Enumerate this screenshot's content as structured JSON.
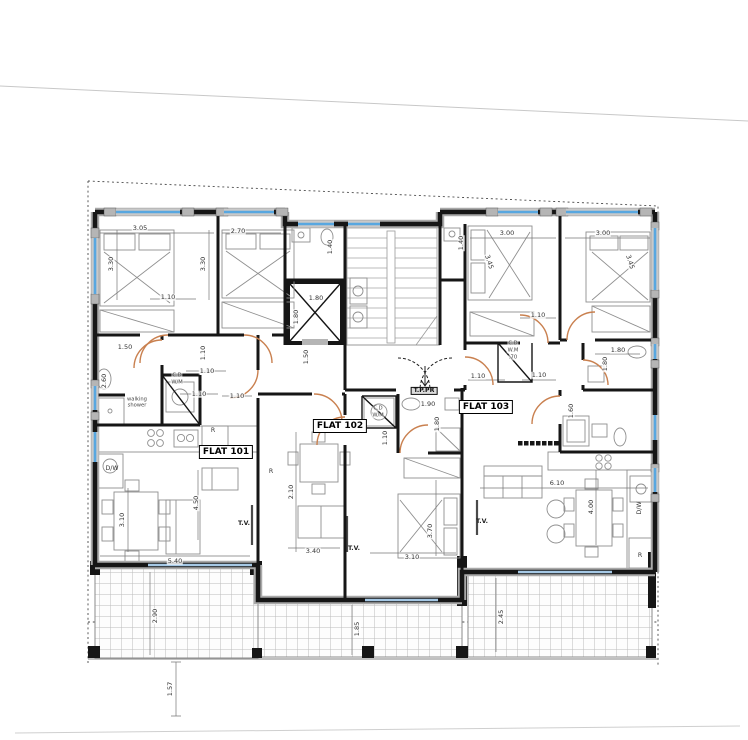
{
  "drawing": {
    "type": "architectural floor plan",
    "flats": [
      {
        "label": "FLAT 101",
        "x": 226,
        "y": 452
      },
      {
        "label": "FLAT 102",
        "x": 340,
        "y": 426
      },
      {
        "label": "FLAT 103",
        "x": 486,
        "y": 407
      }
    ]
  },
  "colors": {
    "wall": "#161616",
    "wall_halo": "#a9a9a9",
    "window": "#58a7e0",
    "terrace_glass": "#a6c9e6",
    "door_arc": "#c9804f",
    "dimension": "#333333",
    "tile_line": "#bcbcbc",
    "boundary": "#4a4a4a"
  },
  "dim_labels": [
    {
      "t": "3.05",
      "x": 140,
      "y": 228
    },
    {
      "t": "2.70",
      "x": 238,
      "y": 231
    },
    {
      "t": "3.30",
      "x": 111,
      "y": 264,
      "r": -90
    },
    {
      "t": "3.30",
      "x": 203,
      "y": 264,
      "r": -90
    },
    {
      "t": "1.10",
      "x": 168,
      "y": 297
    },
    {
      "t": "1.40",
      "x": 330,
      "y": 247,
      "r": -90
    },
    {
      "t": "1.80",
      "x": 316,
      "y": 298
    },
    {
      "t": "1.80",
      "x": 296,
      "y": 317,
      "r": -90
    },
    {
      "t": "1.50",
      "x": 306,
      "y": 357,
      "r": -90
    },
    {
      "t": "1.40",
      "x": 461,
      "y": 243,
      "r": -90
    },
    {
      "t": "3.00",
      "x": 507,
      "y": 233
    },
    {
      "t": "3.45",
      "x": 489,
      "y": 262,
      "r": 72
    },
    {
      "t": "3.00",
      "x": 603,
      "y": 233
    },
    {
      "t": "3.45",
      "x": 630,
      "y": 262,
      "r": 72
    },
    {
      "t": "1.10",
      "x": 538,
      "y": 315
    },
    {
      "t": "1.50",
      "x": 125,
      "y": 347
    },
    {
      "t": "2.60",
      "x": 104,
      "y": 381,
      "r": -90
    },
    {
      "t": "1.10",
      "x": 203,
      "y": 353,
      "r": -90
    },
    {
      "t": "1.10",
      "x": 207,
      "y": 371
    },
    {
      "t": "1.10",
      "x": 199,
      "y": 394
    },
    {
      "t": "1.10",
      "x": 237,
      "y": 396
    },
    {
      "t": "1.10",
      "x": 478,
      "y": 376
    },
    {
      "t": "1.10",
      "x": 539,
      "y": 375
    },
    {
      "t": "1.80",
      "x": 618,
      "y": 350
    },
    {
      "t": "1.80",
      "x": 605,
      "y": 364,
      "r": -90
    },
    {
      "t": "1.90",
      "x": 428,
      "y": 404
    },
    {
      "t": "1.80",
      "x": 437,
      "y": 424,
      "r": -90
    },
    {
      "t": "1.60",
      "x": 571,
      "y": 411,
      "r": -90
    },
    {
      "t": "1.10",
      "x": 385,
      "y": 438,
      "r": -90
    },
    {
      "t": "2.10",
      "x": 291,
      "y": 492,
      "r": -90
    },
    {
      "t": "3.40",
      "x": 313,
      "y": 551
    },
    {
      "t": "3.70",
      "x": 430,
      "y": 531,
      "r": -90
    },
    {
      "t": "3.10",
      "x": 412,
      "y": 557
    },
    {
      "t": "4.50",
      "x": 196,
      "y": 503,
      "r": -90
    },
    {
      "t": "5.40",
      "x": 175,
      "y": 561
    },
    {
      "t": "3.10",
      "x": 122,
      "y": 520,
      "r": -90
    },
    {
      "t": "6.10",
      "x": 557,
      "y": 483
    },
    {
      "t": "4.00",
      "x": 591,
      "y": 507,
      "r": -90
    },
    {
      "t": "2.90",
      "x": 155,
      "y": 616,
      "r": -90
    },
    {
      "t": "1.85",
      "x": 357,
      "y": 629,
      "r": -90
    },
    {
      "t": "2.45",
      "x": 501,
      "y": 617,
      "r": -90
    },
    {
      "t": "1.57",
      "x": 170,
      "y": 689,
      "r": -90
    }
  ],
  "room_labels": [
    {
      "t": "walking",
      "x": 137,
      "y": 400,
      "cls": "fix"
    },
    {
      "t": "shower",
      "x": 137,
      "y": 406,
      "cls": "fix"
    },
    {
      "t": "C.D",
      "x": 177,
      "y": 376,
      "cls": "fix"
    },
    {
      "t": "W/M",
      "x": 177,
      "y": 383,
      "cls": "fix"
    },
    {
      "t": "C.D",
      "x": 378,
      "y": 409,
      "cls": "fix"
    },
    {
      "t": "W/M",
      "x": 378,
      "y": 416,
      "cls": "fix"
    },
    {
      "t": "C.D",
      "x": 513,
      "y": 344,
      "cls": "fix"
    },
    {
      "t": "W.M",
      "x": 513,
      "y": 351,
      "cls": "fix"
    },
    {
      "t": ".70",
      "x": 513,
      "y": 358,
      "cls": "fix"
    },
    {
      "t": "T.P.PR",
      "x": 424,
      "y": 391,
      "cls": "panel"
    },
    {
      "t": "D/W",
      "x": 112,
      "y": 469,
      "cls": "app"
    },
    {
      "t": "D/W",
      "x": 640,
      "y": 508,
      "r": -90,
      "cls": "app"
    },
    {
      "t": "R",
      "x": 213,
      "y": 431,
      "cls": "app"
    },
    {
      "t": "R",
      "x": 271,
      "y": 472,
      "cls": "app"
    },
    {
      "t": "R",
      "x": 640,
      "y": 556,
      "cls": "app"
    },
    {
      "t": "T.V.",
      "x": 244,
      "y": 524,
      "cls": "tv"
    },
    {
      "t": "T.V.",
      "x": 354,
      "y": 549,
      "cls": "tv"
    },
    {
      "t": "T.V.",
      "x": 482,
      "y": 522,
      "cls": "tv"
    }
  ]
}
